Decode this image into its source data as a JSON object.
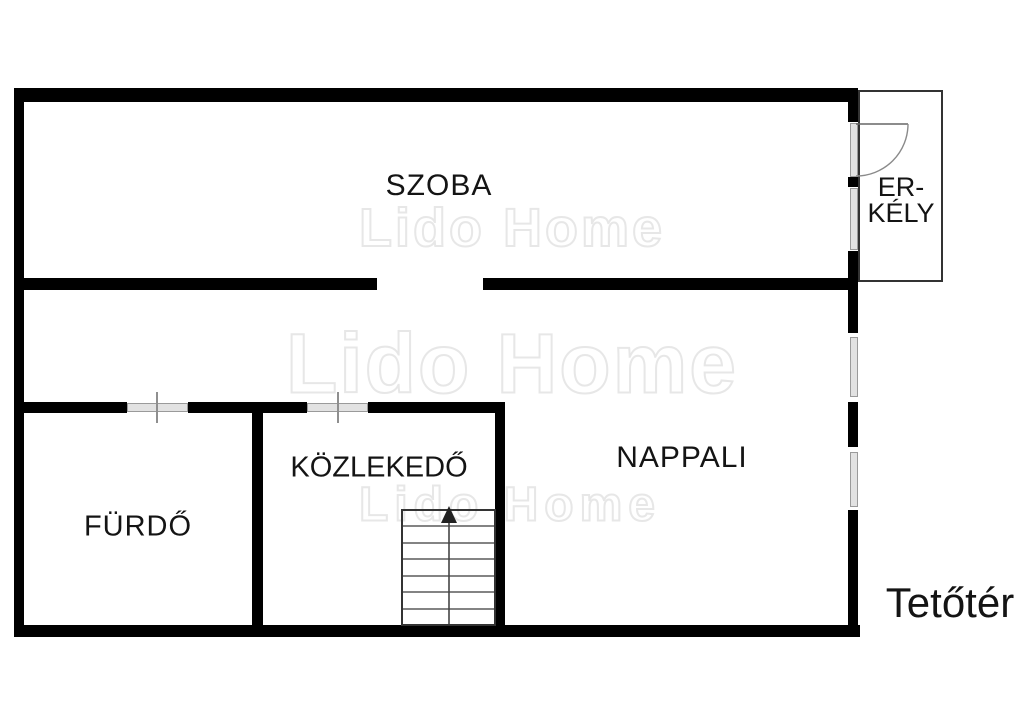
{
  "labels": {
    "szoba": "SZOBA",
    "erkely_line1": "ER-",
    "erkely_line2": "KÉLY",
    "nappali": "NAPPALI",
    "kozlekedo": "KÖZLEKEDŐ",
    "furdo": "FÜRDŐ",
    "floor": "Tetőtér"
  },
  "watermark": {
    "text": "Lido Home"
  },
  "icons": {
    "stairs_direction": "up-arrow-icon"
  },
  "colors": {
    "wall": "#000000",
    "line": "#333333",
    "window_fill": "#e2e2e2",
    "window_edge": "#9a9a9a",
    "text": "#141414",
    "watermark_outline": "#e7e7e7"
  }
}
